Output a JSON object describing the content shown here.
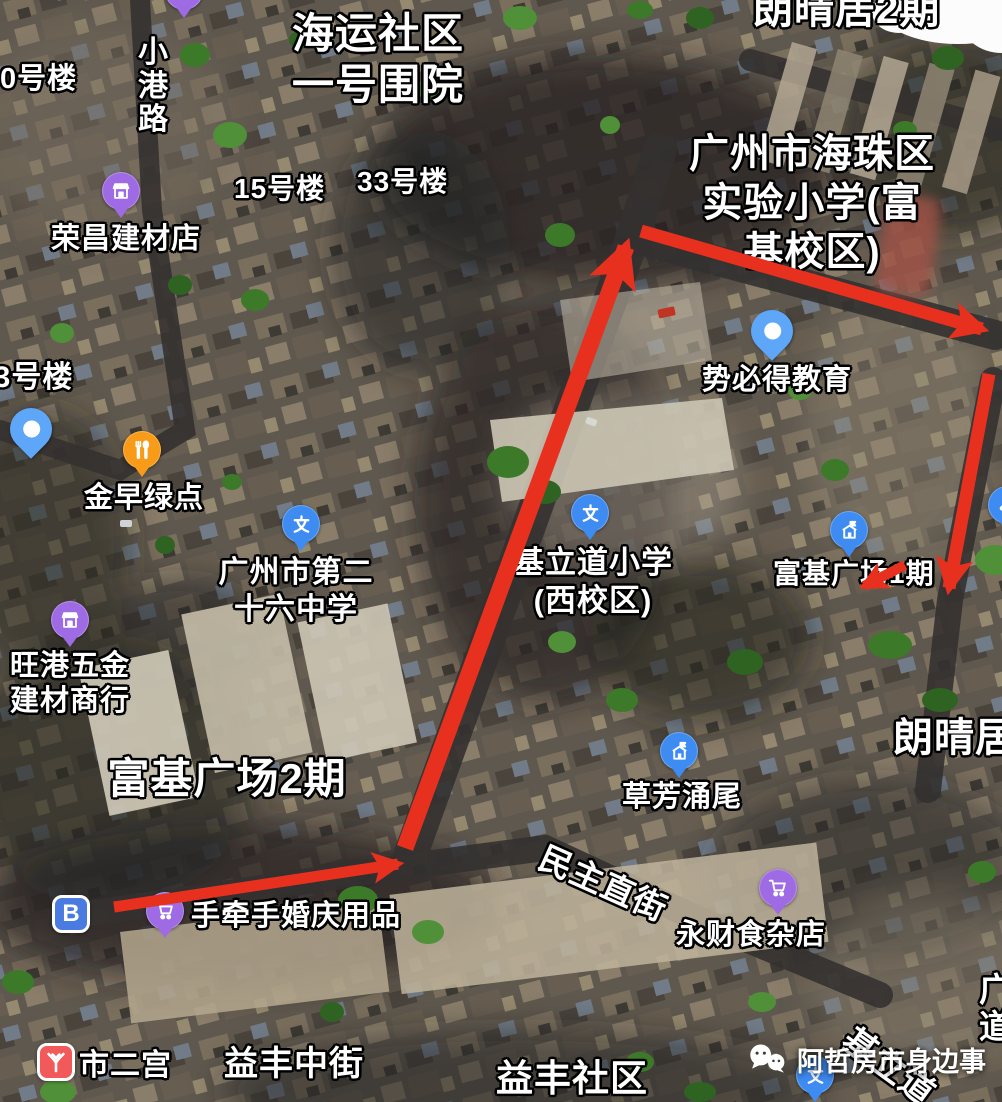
{
  "map": {
    "description": "卫星地图 广州市海珠区 富基广场周边 步行路线标注",
    "annotation_color": "#e8301f",
    "pin_colors": {
      "blue": "#3E8CF2",
      "light_blue": "#5EA6F8",
      "purple": "#9E6BE4",
      "orange": "#F79B18",
      "metro_red": "#F2595B",
      "badge_blue": "#4A7BE0"
    },
    "labels": [
      {
        "name": "building-0",
        "text": "0号楼",
        "x": 0,
        "y": 62,
        "size": 29
      },
      {
        "name": "street-xiaogang-lu",
        "text": "小港路",
        "x": 138,
        "y": 36,
        "size": 30,
        "vertical": true
      },
      {
        "name": "area-haiyun-shequ",
        "lines": [
          "海运社区",
          "一号围院"
        ],
        "cx": 378,
        "y": 8,
        "size": 42
      },
      {
        "name": "area-langqingju-2qi-top",
        "text": "朗晴居2期",
        "x": 753,
        "y": -14,
        "size": 40
      },
      {
        "name": "building-15",
        "text": "15号楼",
        "x": 234,
        "y": 172,
        "size": 28
      },
      {
        "name": "building-33",
        "text": "33号楼",
        "x": 357,
        "y": 165,
        "size": 28
      },
      {
        "name": "area-shiyan-xiaoxue",
        "lines": [
          "广州市海珠区",
          "实验小学(富",
          "基校区)"
        ],
        "cx": 812,
        "y": 130,
        "size": 40
      },
      {
        "name": "building-83",
        "text": "83号楼",
        "x": -24,
        "y": 360,
        "size": 30
      },
      {
        "name": "poi-rongchang-jiancai",
        "text": "荣昌建材店",
        "x": 51,
        "y": 222,
        "size": 29,
        "poi": true
      },
      {
        "name": "poi-jinzao-lvdian",
        "text": "金早绿点",
        "x": 84,
        "y": 481,
        "size": 29,
        "poi": true
      },
      {
        "name": "poi-di26-zhongxue",
        "lines": [
          "广州市第二",
          "十六中学"
        ],
        "cx": 296,
        "y": 555,
        "size": 30,
        "poi": true
      },
      {
        "name": "poi-jilidao-xiaoxue",
        "lines": [
          "基立道小学",
          "(西校区)"
        ],
        "cx": 593,
        "y": 544,
        "size": 31,
        "poi": true
      },
      {
        "name": "poi-shibide-jiaoyu",
        "text": "势必得教育",
        "x": 702,
        "y": 363,
        "size": 29,
        "poi": true
      },
      {
        "name": "poi-fuji-1qi",
        "text": "富基广场1期",
        "x": 773,
        "y": 557,
        "size": 28,
        "poi": true
      },
      {
        "name": "poi-wanggang-wujin",
        "lines": [
          "旺港五金",
          "建材商行"
        ],
        "x": 10,
        "y": 649,
        "size": 29,
        "poi": true
      },
      {
        "name": "area-fuji-2qi",
        "text": "富基广场2期",
        "cx": 227,
        "y": 753,
        "size": 42
      },
      {
        "name": "area-langqingju-right",
        "text": "朗晴居2期",
        "x": 893,
        "y": 714,
        "size": 40
      },
      {
        "name": "poi-caofang-yongwei",
        "text": "草芳涌尾",
        "x": 622,
        "y": 780,
        "size": 29,
        "poi": true
      },
      {
        "name": "street-minzhu-zhijie",
        "text": "民主直街",
        "x": 549,
        "y": 838,
        "size": 33,
        "rotate": 24
      },
      {
        "name": "poi-yongcai-shizadian",
        "text": "永财食杂店",
        "x": 676,
        "y": 918,
        "size": 29,
        "poi": true
      },
      {
        "name": "poi-shouqianshou-hunqing",
        "text": "手牵手婚庆用品",
        "x": 191,
        "y": 899,
        "size": 29,
        "poi": true
      },
      {
        "name": "poi-shiergong",
        "text": "市二宫",
        "x": 79,
        "y": 1048,
        "size": 30,
        "poi": true
      },
      {
        "name": "street-yifeng-zhongjie",
        "text": "益丰中街",
        "x": 224,
        "y": 1044,
        "size": 34
      },
      {
        "name": "area-yifeng-shequ",
        "text": "益丰社区",
        "x": 496,
        "y": 1056,
        "size": 37
      },
      {
        "name": "street-jilidao",
        "text": "基立道",
        "x": 858,
        "y": 1020,
        "size": 34,
        "rotate": 36
      },
      {
        "name": "street-guang-dao",
        "text": "广道",
        "x": 979,
        "y": 972,
        "size": 33,
        "vertical": true
      }
    ],
    "pins": [
      {
        "name": "pin-rongchang-store",
        "icon": "store",
        "style": "round",
        "color": "purple",
        "x": 121,
        "y": 191
      },
      {
        "name": "pin-top-edge",
        "icon": "dot",
        "style": "round",
        "color": "purple",
        "x": 184,
        "y": -9
      },
      {
        "name": "pin-left-location",
        "icon": "dot",
        "style": "teardrop",
        "color": "light_blue",
        "x": 31,
        "y": 429
      },
      {
        "name": "pin-jinzao-restaurant",
        "icon": "restaurant",
        "style": "round",
        "color": "orange",
        "x": 142,
        "y": 450
      },
      {
        "name": "pin-di26-school",
        "icon": "education",
        "style": "round",
        "color": "blue",
        "x": 301,
        "y": 524
      },
      {
        "name": "pin-jilidao-school",
        "icon": "education",
        "style": "round",
        "color": "blue",
        "x": 590,
        "y": 513
      },
      {
        "name": "pin-shibide-location",
        "icon": "dot",
        "style": "teardrop",
        "color": "light_blue",
        "x": 772,
        "y": 331
      },
      {
        "name": "pin-fuji-phase1",
        "icon": "building",
        "style": "round",
        "color": "blue",
        "x": 849,
        "y": 530
      },
      {
        "name": "pin-wrench",
        "icon": "wrench",
        "style": "round",
        "color": "blue",
        "x": 1007,
        "y": 505
      },
      {
        "name": "pin-wanggang-store",
        "icon": "store",
        "style": "round",
        "color": "purple",
        "x": 70,
        "y": 620
      },
      {
        "name": "pin-caofang",
        "icon": "building",
        "style": "round",
        "color": "blue",
        "x": 679,
        "y": 751
      },
      {
        "name": "pin-yongcai-cart",
        "icon": "cart",
        "style": "round",
        "color": "purple",
        "x": 778,
        "y": 888
      },
      {
        "name": "pin-shouqianshou-cart",
        "icon": "cart",
        "style": "round",
        "color": "purple",
        "x": 165,
        "y": 911
      },
      {
        "name": "badge-b",
        "icon": "letter-b",
        "style": "square",
        "color": "badge_blue",
        "x": 71,
        "y": 914,
        "text": "B"
      },
      {
        "name": "badge-metro-shiergong",
        "icon": "metro",
        "style": "square",
        "color": "metro_red",
        "x": 56,
        "y": 1062
      },
      {
        "name": "pin-bottom-partial",
        "icon": "education",
        "style": "round",
        "color": "blue",
        "x": 815,
        "y": 1075
      }
    ],
    "arrows": [
      {
        "name": "route-arrow-main",
        "x1": 405,
        "y1": 848,
        "x2": 626,
        "y2": 247,
        "w": 17
      },
      {
        "name": "route-arrow-top",
        "x1": 641,
        "y1": 231,
        "x2": 982,
        "y2": 329,
        "w": 13
      },
      {
        "name": "route-arrow-right",
        "x1": 989,
        "y1": 374,
        "x2": 949,
        "y2": 588,
        "w": 13
      },
      {
        "name": "route-arrow-bottom",
        "x1": 114,
        "y1": 907,
        "x2": 398,
        "y2": 864,
        "w": 11
      },
      {
        "name": "route-mark-phase1",
        "x1": 905,
        "y1": 565,
        "x2": 864,
        "y2": 586,
        "w": 10
      }
    ],
    "watermark": {
      "icon": "wechat-icon",
      "text": "阿哲房市身边事"
    },
    "speech_bubble": {
      "present": true,
      "position": "top-right"
    }
  }
}
